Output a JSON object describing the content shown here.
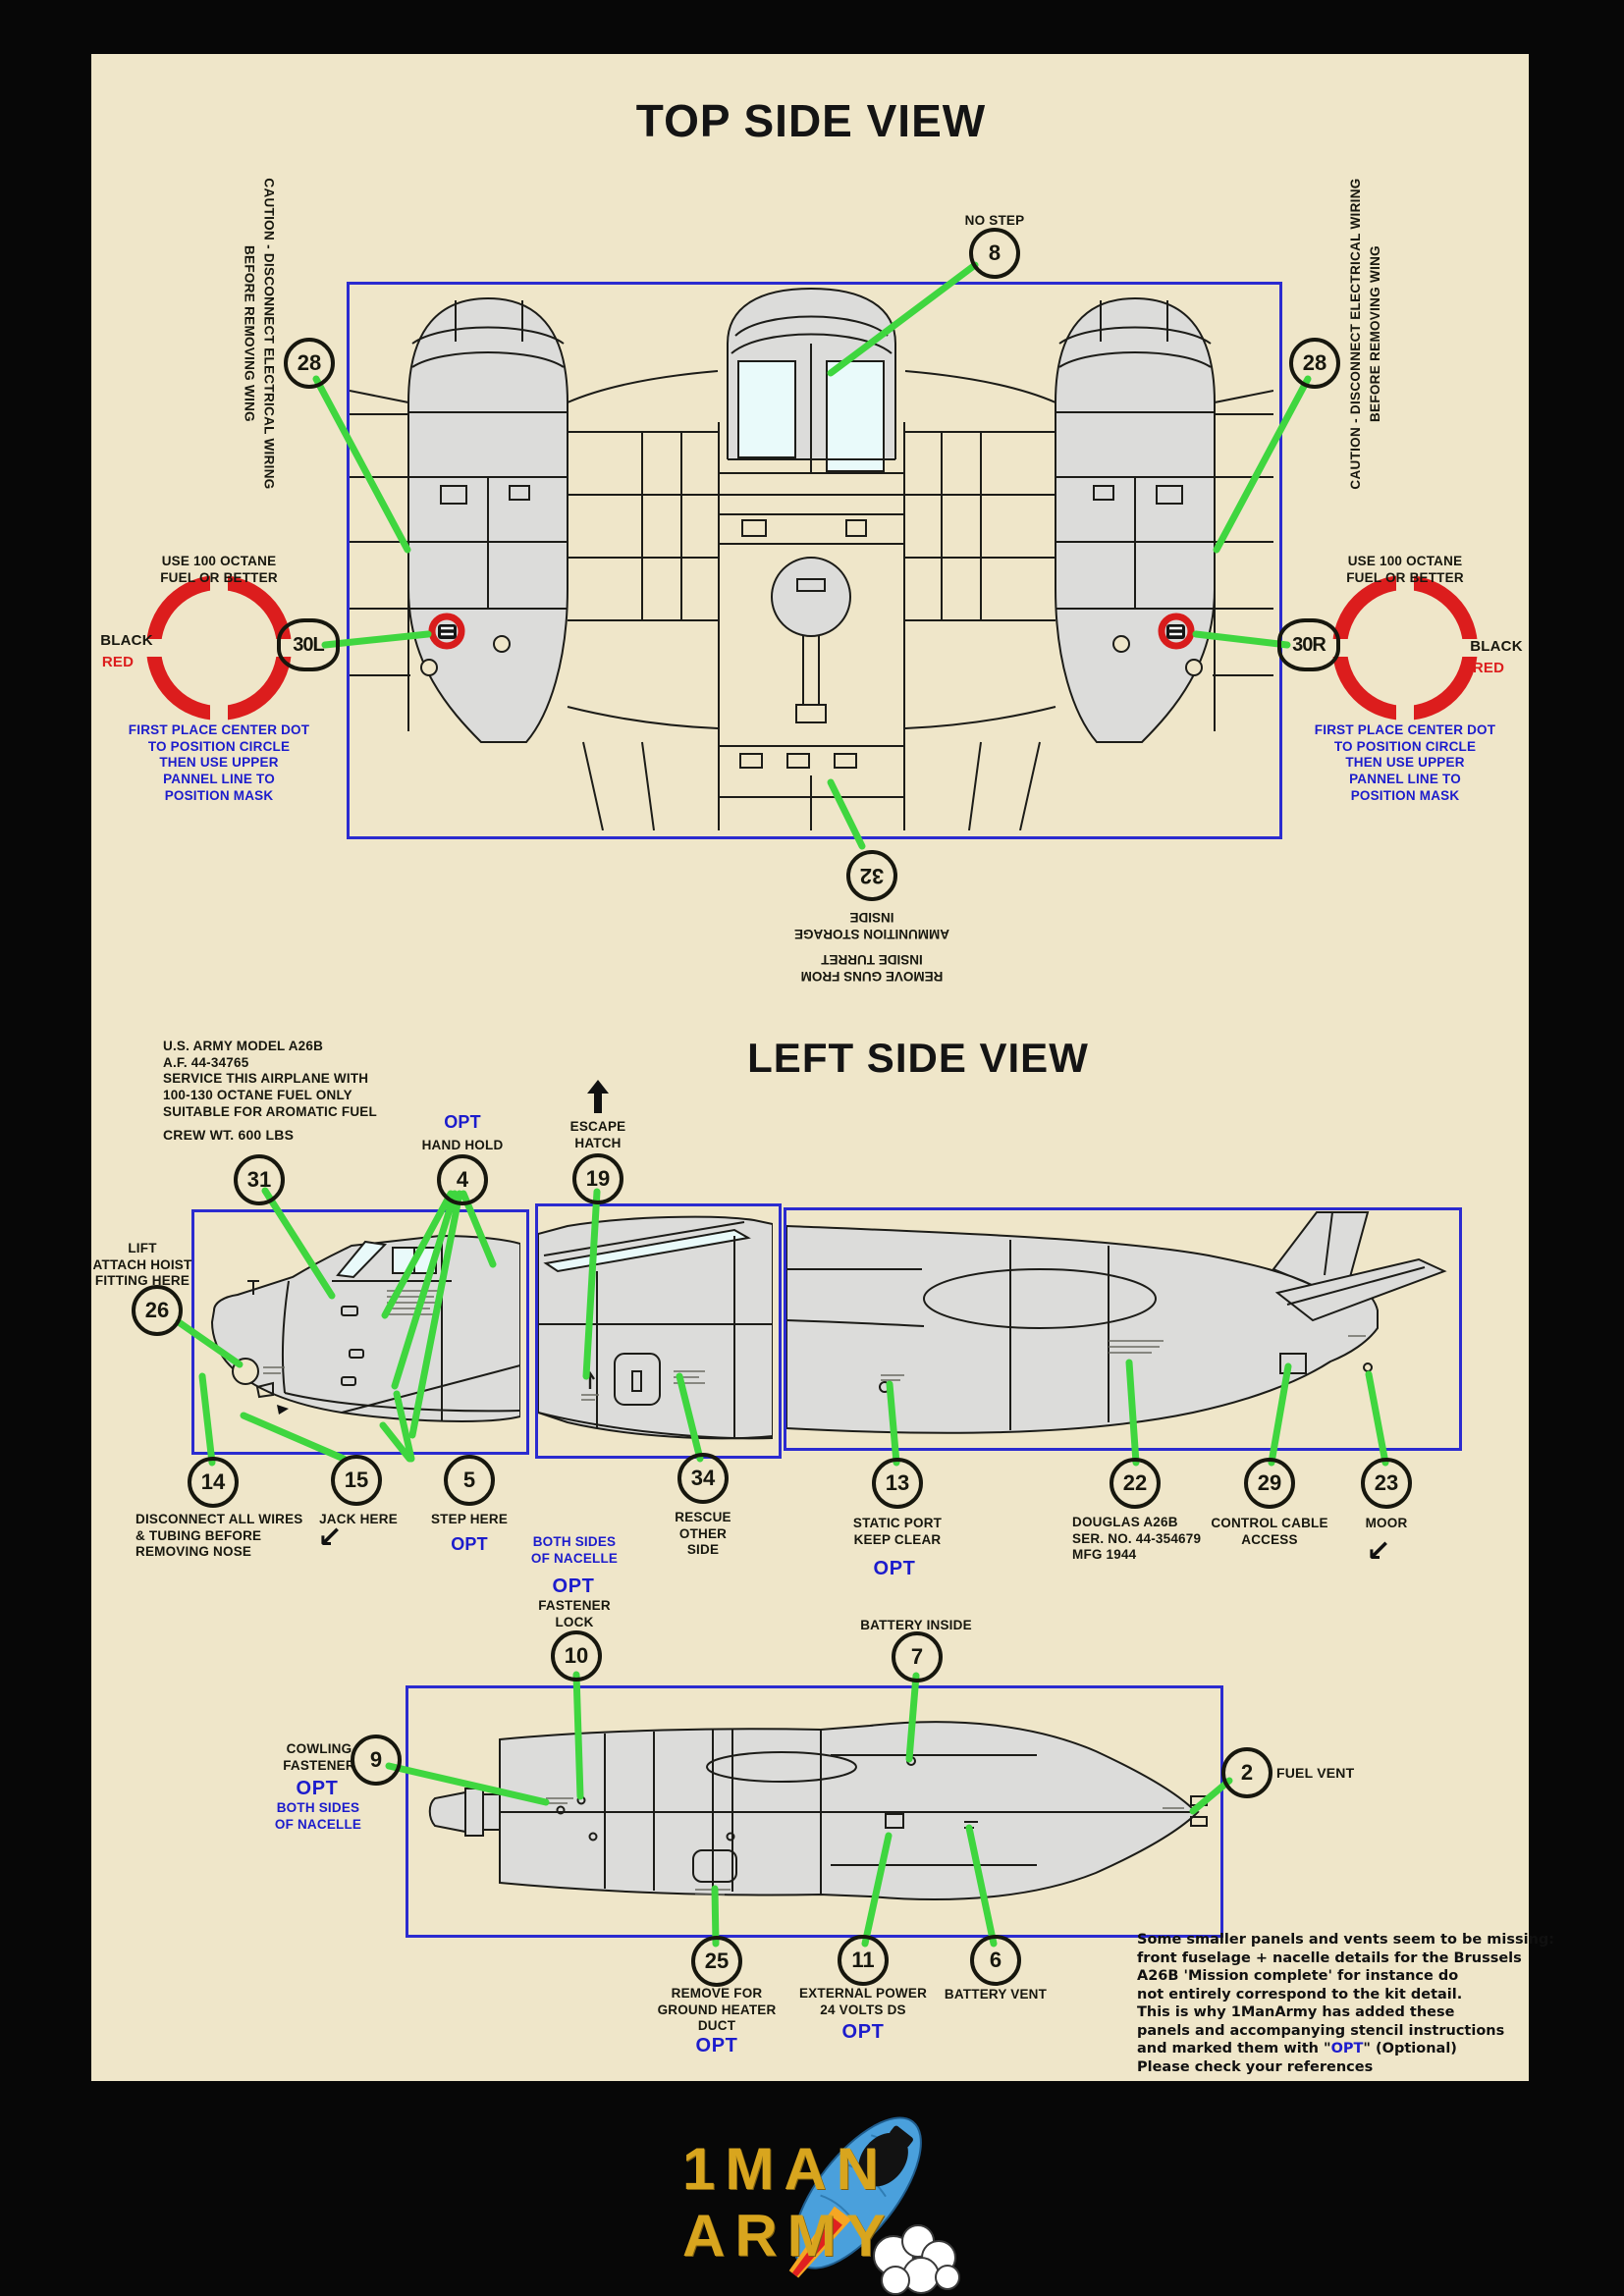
{
  "colors": {
    "sheet": "#efe6c9",
    "green": "#3fd63f",
    "blue_text": "#1c1ccc",
    "red": "#dc1d1d",
    "box_border": "#2b2bd0"
  },
  "titles": {
    "top": "TOP SIDE VIEW",
    "side": "LEFT SIDE VIEW"
  },
  "top_view": {
    "no_step": {
      "num": "8",
      "label": "NO STEP"
    },
    "caution": "CAUTION - DISCONNECT ELECTRICAL WIRING\nBEFORE REMOVING WING",
    "wing_num": "28",
    "fuel": {
      "header": "USE 100 OCTANE\nFUEL OR BETTER",
      "black": "BLACK",
      "red": "RED",
      "left_num": "30L",
      "right_num": "30R",
      "note": "FIRST PLACE CENTER DOT\nTO POSITION CIRCLE\nTHEN USE UPPER\nPANNEL LINE TO\nPOSITION MASK"
    },
    "turret": {
      "num": "32",
      "storage": "AMMUNITION STORAGE\nINSIDE",
      "remove": "REMOVE GUNS FROM\nINSIDE TURRET"
    }
  },
  "side_view": {
    "army_stencil": "U.S. ARMY MODEL A26B\nA.F. 44-34765\nSERVICE THIS AIRPLANE WITH\n100-130 OCTANE FUEL ONLY\nSUITABLE FOR AROMATIC FUEL",
    "crew": "CREW WT.  600 LBS",
    "c31": {
      "num": "31"
    },
    "c4": {
      "num": "4",
      "opt": "OPT",
      "label": "HAND HOLD"
    },
    "c19": {
      "num": "19",
      "label": "ESCAPE\nHATCH"
    },
    "c26": {
      "num": "26",
      "label": "LIFT\nATTACH HOIST\nFITTING HERE"
    },
    "c14": {
      "num": "14",
      "label": "DISCONNECT ALL WIRES\n& TUBING BEFORE\nREMOVING NOSE"
    },
    "c15": {
      "num": "15",
      "label": "JACK HERE"
    },
    "c5": {
      "num": "5",
      "label": "STEP HERE",
      "opt": "OPT"
    },
    "c34": {
      "num": "34",
      "label": "RESCUE\nOTHER\nSIDE"
    },
    "c13": {
      "num": "13",
      "label": "STATIC PORT\nKEEP CLEAR",
      "opt": "OPT"
    },
    "c22": {
      "num": "22",
      "label": "DOUGLAS A26B\nSER. NO. 44-354679\nMFG 1944"
    },
    "c29": {
      "num": "29",
      "label": "CONTROL CABLE\nACCESS"
    },
    "c23": {
      "num": "23",
      "label": "MOOR"
    }
  },
  "bottom_view": {
    "c10": {
      "num": "10",
      "blue": "BOTH SIDES\nOF NACELLE",
      "opt": "OPT",
      "label": "FASTENER\nLOCK"
    },
    "c7": {
      "num": "7",
      "label": "BATTERY INSIDE"
    },
    "c9": {
      "num": "9",
      "label": "COWLING\nFASTENER",
      "opt": "OPT",
      "blue": "BOTH SIDES\nOF NACELLE"
    },
    "c2": {
      "num": "2",
      "label": "FUEL VENT"
    },
    "c25": {
      "num": "25",
      "label": "REMOVE FOR\nGROUND HEATER\nDUCT",
      "opt": "OPT"
    },
    "c11": {
      "num": "11",
      "label": "EXTERNAL POWER\n24 VOLTS DS",
      "opt": "OPT"
    },
    "c6": {
      "num": "6",
      "label": "BATTERY VENT"
    }
  },
  "note": {
    "body": "Some smaller panels and vents seem to be missing:\nfront fuselage + nacelle details for the Brussels\nA26B 'Mission complete' for instance do\nnot entirely correspond to the kit detail.\nThis is why 1ManArmy has added these\npanels and accompanying stencil instructions",
    "l7a": "and marked them with \"",
    "l7b": "OPT",
    "l7c": "\" (Optional)",
    "l8": "Please check your references"
  },
  "logo": {
    "line1": "1MAN",
    "line2": "ARMY"
  }
}
